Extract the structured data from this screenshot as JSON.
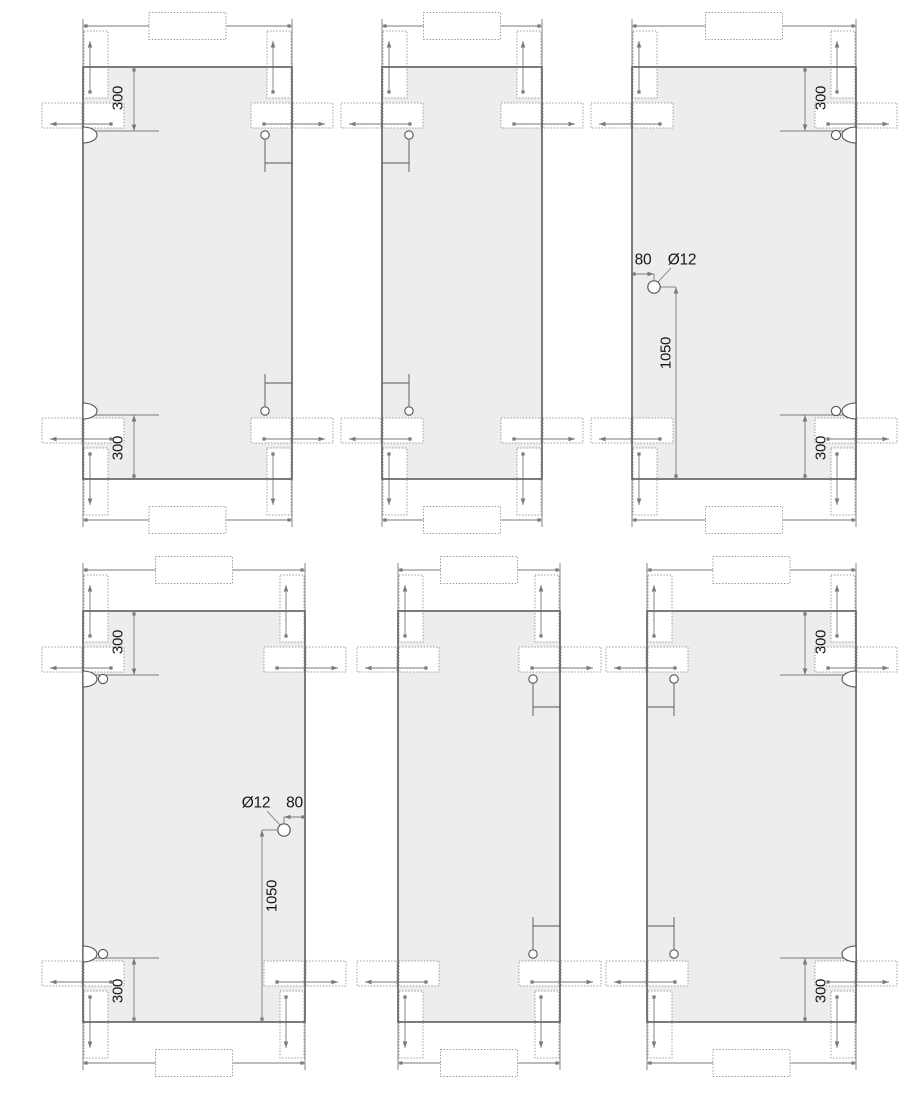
{
  "drawing": {
    "type": "technical-fabrication-drawing",
    "subject": "glass-panel-elevations-with-clamp-fittings",
    "canvas": {
      "width": 900,
      "height": 1111,
      "background": "#ffffff"
    },
    "colors": {
      "glass_fill": "#ededec",
      "glass_stroke": "#666666",
      "dim_line": "#7a7a7a",
      "bracket_line": "#979797",
      "detail_line": "#555555",
      "text": "#161616"
    },
    "panels": [
      {
        "name": "panel-top-left",
        "x": 83,
        "y": 67,
        "width": 209,
        "height": 412,
        "dims_300": [
          {
            "corner": "top-left",
            "value": "300"
          },
          {
            "corner": "bottom-left",
            "value": "300"
          }
        ],
        "notches": [
          {
            "side": "left",
            "pos": "top",
            "pin_hole": false
          },
          {
            "side": "left",
            "pos": "bottom",
            "pin_hole": false
          }
        ],
        "mount_holes": [
          {
            "side": "right",
            "pos": "top"
          },
          {
            "side": "right",
            "pos": "bottom"
          }
        ],
        "drill_hole": null
      },
      {
        "name": "panel-top-middle",
        "x": 382,
        "y": 67,
        "width": 160,
        "height": 412,
        "dims_300": [],
        "notches": [],
        "mount_holes": [
          {
            "side": "left",
            "pos": "top"
          },
          {
            "side": "left",
            "pos": "bottom"
          }
        ],
        "drill_hole": null
      },
      {
        "name": "panel-top-right",
        "x": 632,
        "y": 67,
        "width": 224,
        "height": 412,
        "dims_300": [
          {
            "corner": "top-right",
            "value": "300"
          },
          {
            "corner": "bottom-right",
            "value": "300"
          }
        ],
        "notches": [
          {
            "side": "right",
            "pos": "top",
            "pin_hole": true
          },
          {
            "side": "right",
            "pos": "bottom",
            "pin_hole": true
          }
        ],
        "mount_holes": [],
        "drill_hole": {
          "cx": 654,
          "cy": 287,
          "offset_side": "left",
          "offset_label": "80",
          "diameter_label": "Ø12",
          "height_label": "1050"
        }
      },
      {
        "name": "panel-bottom-left",
        "x": 83,
        "y": 611,
        "width": 222,
        "height": 411,
        "dims_300": [
          {
            "corner": "top-left",
            "value": "300"
          },
          {
            "corner": "bottom-left",
            "value": "300"
          }
        ],
        "notches": [
          {
            "side": "left",
            "pos": "top",
            "pin_hole": true
          },
          {
            "side": "left",
            "pos": "bottom",
            "pin_hole": true
          }
        ],
        "mount_holes": [],
        "drill_hole": {
          "cx": 284,
          "cy": 830,
          "offset_side": "right",
          "offset_label": "80",
          "diameter_label": "Ø12",
          "height_label": "1050"
        }
      },
      {
        "name": "panel-bottom-middle",
        "x": 398,
        "y": 611,
        "width": 162,
        "height": 411,
        "dims_300": [],
        "notches": [],
        "mount_holes": [
          {
            "side": "right",
            "pos": "top"
          },
          {
            "side": "right",
            "pos": "bottom"
          }
        ],
        "drill_hole": null
      },
      {
        "name": "panel-bottom-right",
        "x": 647,
        "y": 611,
        "width": 209,
        "height": 411,
        "dims_300": [
          {
            "corner": "top-right",
            "value": "300"
          },
          {
            "corner": "bottom-right",
            "value": "300"
          }
        ],
        "notches": [
          {
            "side": "right",
            "pos": "top",
            "pin_hole": false
          },
          {
            "side": "right",
            "pos": "bottom",
            "pin_hole": false
          }
        ],
        "mount_holes": [
          {
            "side": "left",
            "pos": "top"
          },
          {
            "side": "left",
            "pos": "bottom"
          }
        ],
        "drill_hole": null
      }
    ]
  }
}
